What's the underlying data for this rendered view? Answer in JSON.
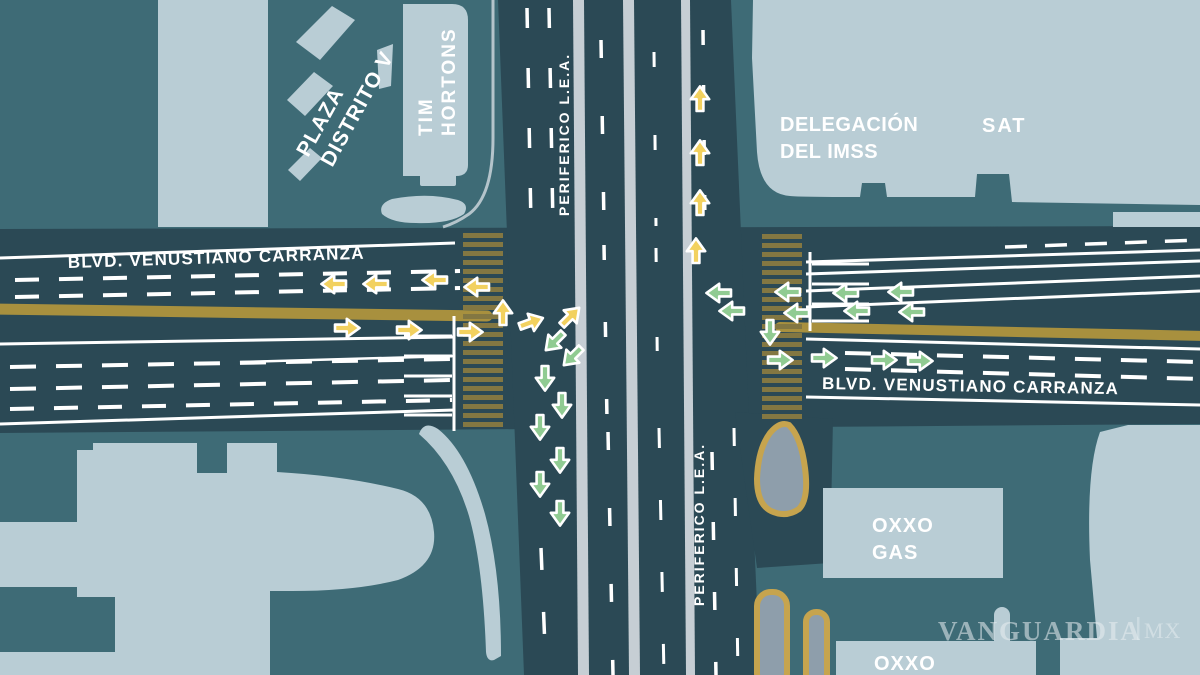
{
  "map": {
    "road_labels": {
      "blvd_west": "BLVD. VENUSTIANO CARRANZA",
      "blvd_east": "BLVD. VENUSTIANO CARRANZA",
      "periferico_north": "PERIFERICO L.E.A.",
      "periferico_south": "PERIFERICO L.E.A."
    },
    "places": {
      "plaza_line1": "PLAZA",
      "plaza_line2": "DISTRITO V",
      "tim_line1": "TIM",
      "tim_line2": "HORTONS",
      "imss_line1": "DELEGACIÓN",
      "imss_line2": "DEL IMSS",
      "sat": "SAT",
      "oxxo_gas_line1": "OXXO",
      "oxxo_gas_line2": "GAS",
      "oxxo": "OXXO"
    },
    "watermark": {
      "brand": "VANGUARDIA",
      "suffix": "MX"
    },
    "colors": {
      "background": "#3E6B76",
      "road": "#2B4955",
      "building": "#B9CDD5",
      "median_strip": "#C6CED4",
      "island_fill": "#8E9EAB",
      "island_outline": "#C6A44E",
      "median_bar": "#A8903E",
      "crosswalk_stripe": "#837742",
      "arrow_yellow": "#F2D15F",
      "arrow_green": "#90CB92",
      "marking_white": "#FFFFFF"
    },
    "traffic_arrows": [
      {
        "dir": "left",
        "c": "yellow",
        "x": 333,
        "y": 284,
        "r": -90
      },
      {
        "dir": "left",
        "c": "yellow",
        "x": 375,
        "y": 284,
        "r": -90
      },
      {
        "dir": "left",
        "c": "yellow",
        "x": 434,
        "y": 280,
        "r": -90
      },
      {
        "dir": "left",
        "c": "yellow",
        "x": 476,
        "y": 287,
        "r": -90
      },
      {
        "dir": "right",
        "c": "yellow",
        "x": 348,
        "y": 328,
        "r": 90
      },
      {
        "dir": "right",
        "c": "yellow",
        "x": 410,
        "y": 330,
        "r": 90
      },
      {
        "dir": "right",
        "c": "yellow",
        "x": 471,
        "y": 332,
        "r": 90
      },
      {
        "dir": "up",
        "c": "yellow",
        "x": 503,
        "y": 312,
        "r": 0
      },
      {
        "dir": "up",
        "c": "yellow",
        "x": 700,
        "y": 98,
        "r": 0
      },
      {
        "dir": "up",
        "c": "yellow",
        "x": 700,
        "y": 152,
        "r": 0
      },
      {
        "dir": "up",
        "c": "yellow",
        "x": 700,
        "y": 202,
        "r": 0
      },
      {
        "dir": "up",
        "c": "yellow",
        "x": 696,
        "y": 250,
        "r": 0
      },
      {
        "dir": "up-right",
        "c": "yellow",
        "x": 532,
        "y": 322,
        "r": 70
      },
      {
        "dir": "up-right",
        "c": "yellow",
        "x": 571,
        "y": 316,
        "r": 45
      },
      {
        "dir": "down-left",
        "c": "green",
        "x": 554,
        "y": 342,
        "r": 225
      },
      {
        "dir": "down-left",
        "c": "green",
        "x": 572,
        "y": 357,
        "r": 225
      },
      {
        "dir": "down",
        "c": "green",
        "x": 545,
        "y": 379,
        "r": 180
      },
      {
        "dir": "down",
        "c": "green",
        "x": 562,
        "y": 406,
        "r": 180
      },
      {
        "dir": "down",
        "c": "green",
        "x": 540,
        "y": 428,
        "r": 180
      },
      {
        "dir": "down",
        "c": "green",
        "x": 560,
        "y": 461,
        "r": 180
      },
      {
        "dir": "down",
        "c": "green",
        "x": 540,
        "y": 485,
        "r": 180
      },
      {
        "dir": "down",
        "c": "green",
        "x": 560,
        "y": 514,
        "r": 180
      },
      {
        "dir": "down",
        "c": "green",
        "x": 770,
        "y": 333,
        "r": 180
      },
      {
        "dir": "left",
        "c": "green",
        "x": 718,
        "y": 293,
        "r": -90
      },
      {
        "dir": "left",
        "c": "green",
        "x": 731,
        "y": 311,
        "r": -90
      },
      {
        "dir": "left",
        "c": "green",
        "x": 787,
        "y": 292,
        "r": -90
      },
      {
        "dir": "left",
        "c": "green",
        "x": 796,
        "y": 313,
        "r": -90
      },
      {
        "dir": "left",
        "c": "green",
        "x": 845,
        "y": 293,
        "r": -90
      },
      {
        "dir": "left",
        "c": "green",
        "x": 856,
        "y": 311,
        "r": -90
      },
      {
        "dir": "left",
        "c": "green",
        "x": 900,
        "y": 292,
        "r": -90
      },
      {
        "dir": "left",
        "c": "green",
        "x": 911,
        "y": 312,
        "r": -90
      },
      {
        "dir": "right",
        "c": "green",
        "x": 781,
        "y": 360,
        "r": 90
      },
      {
        "dir": "right",
        "c": "green",
        "x": 825,
        "y": 358,
        "r": 90
      },
      {
        "dir": "right",
        "c": "green",
        "x": 885,
        "y": 360,
        "r": 90
      },
      {
        "dir": "right",
        "c": "green",
        "x": 921,
        "y": 361,
        "r": 90
      }
    ]
  }
}
